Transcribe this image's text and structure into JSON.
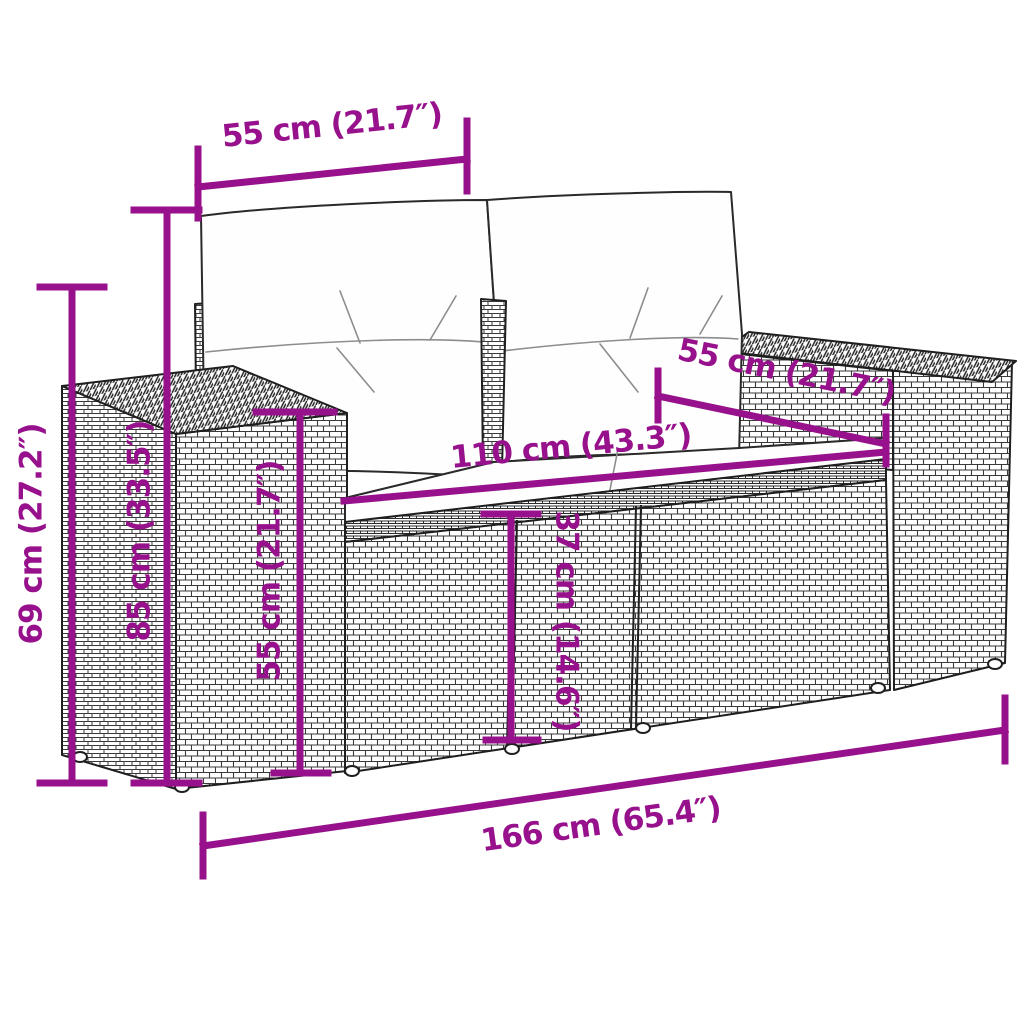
{
  "figure": {
    "subject": "2-seater poly rattan garden sofa with back and seat cushions, technical dimension drawing",
    "style": {
      "dimension_color": "#98118C",
      "line_art_color": "#1f1f1f",
      "background": "#ffffff"
    }
  },
  "dimensions": {
    "backrest_top_width": {
      "label": "55 cm (21.7″)"
    },
    "total_height": {
      "label": "69 cm (27.2″)"
    },
    "backrest_height": {
      "label": "85 cm (33.5″)"
    },
    "armrest_height": {
      "label": "55 cm (21.7″)"
    },
    "seat_width": {
      "label": "110 cm (43.3″)"
    },
    "seat_depth": {
      "label": "55 cm (21.7″)"
    },
    "seat_height": {
      "label": "37 cm (14.6″)"
    },
    "total_width": {
      "label": "166 cm (65.4″)"
    }
  }
}
